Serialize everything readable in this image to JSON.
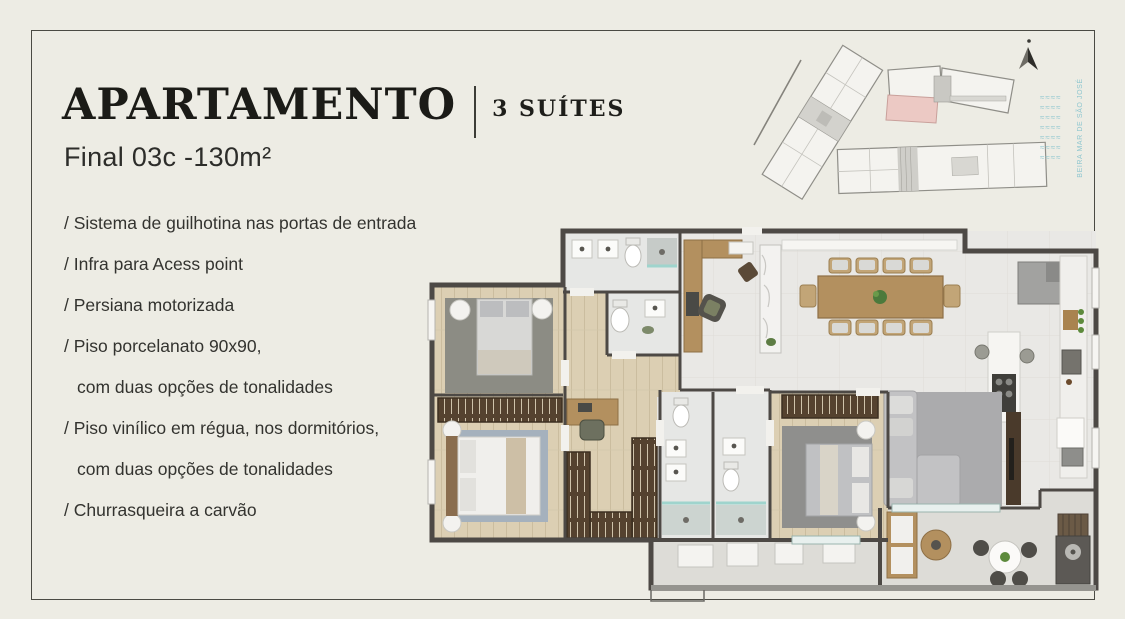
{
  "header": {
    "title": "APARTAMENTO",
    "suites_label": "3 SUÍTES",
    "unit_label": "Final 03c -130m²"
  },
  "features": [
    "/ Sistema de guilhotina nas portas de entrada",
    "/ Infra para Acess point",
    "/ Persiana motorizada",
    "/ Piso porcelanato 90x90,",
    "com duas opções de tonalidades",
    "/ Piso vinílico em régua, nos dormitórios,",
    "com duas opções de tonalidades",
    "/ Churrasqueira a carvão"
  ],
  "site_plan": {
    "water_label": "BEIRA MAR DE SÃO JOSÉ",
    "waves": "≈≈≈≈"
  },
  "colors": {
    "background": "#edece4",
    "frame_line": "#4a4a43",
    "ink": "#1b1b17",
    "body_text": "#33332f",
    "teal_accent": "#8ec6cf",
    "highlight_unit_pink": "#ecc9c4",
    "wall": "#4d4945",
    "wood_floor": "#dccfb3",
    "tile_floor": "#e9e8e5",
    "balcony_floor": "#dddcd7",
    "furniture_wood": "#b3905f"
  }
}
